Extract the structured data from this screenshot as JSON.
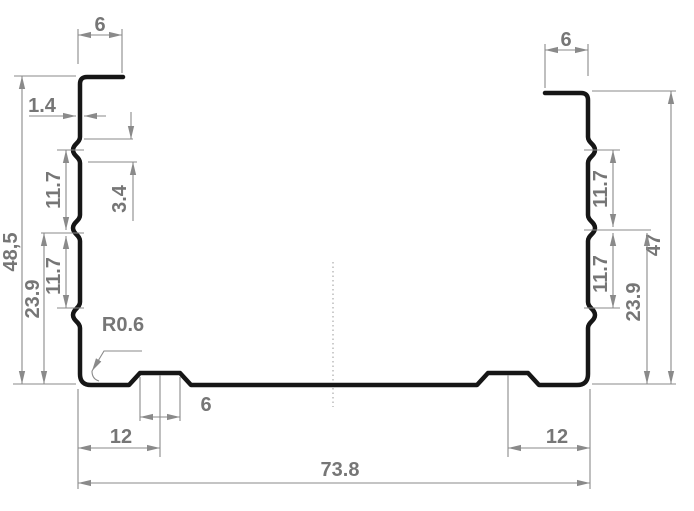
{
  "drawing": {
    "type": "profile-cross-section",
    "colors": {
      "profile_line": "#161616",
      "dimension_line": "#8a8a8a",
      "dimension_text": "#767676"
    },
    "dimensions": {
      "top_lip_left": "6",
      "top_lip_right": "6",
      "material_thickness": "1.4",
      "bead_depth": "3.4",
      "height_left": "48,5",
      "height_right": "47",
      "bead_pitch_left_upper": "11.7",
      "bead_pitch_left_lower": "11.7",
      "bead_pitch_right_upper": "11.7",
      "bead_pitch_right_lower": "11.7",
      "bead_to_base_left": "23.9",
      "bead_to_base_right": "23.9",
      "corner_radius": "R0.6",
      "rib_top_width": "6",
      "rib_offset_left": "12",
      "rib_offset_right": "12",
      "overall_width": "73.8"
    }
  }
}
